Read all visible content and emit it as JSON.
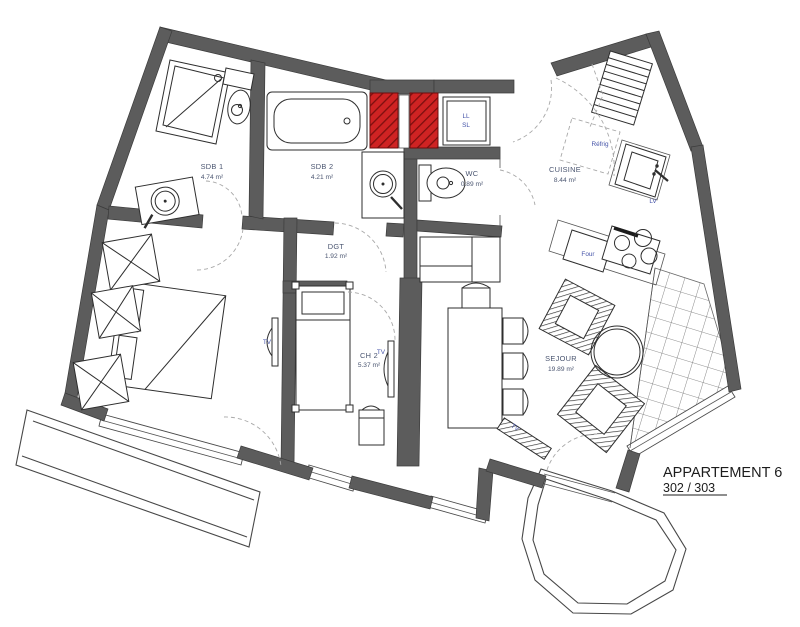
{
  "title": {
    "line1": "APPARTEMENT 6",
    "line2": "302 / 303"
  },
  "rooms": {
    "sdb1": {
      "name": "SDB 1",
      "area": "4.74 m²"
    },
    "sdb2": {
      "name": "SDB 2",
      "area": "4.21 m²"
    },
    "wc": {
      "name": "WC",
      "area": "0.89 m²"
    },
    "cuisine": {
      "name": "CUISINE",
      "area": "8.44 m²"
    },
    "dgt": {
      "name": "DGT",
      "area": "1.92 m²"
    },
    "ch2": {
      "name": "CH 2",
      "area": "5.37 m²"
    },
    "sejour": {
      "name": "SEJOUR",
      "area": "19.89 m²"
    }
  },
  "appliances": {
    "washer_line1": "LL",
    "washer_line2": "SL",
    "fridge": "Réfrig",
    "dishwasher": "LV",
    "oven": "Four",
    "tv_ch1": "TV",
    "tv_ch2": "TV",
    "tv_sejour": "TV"
  },
  "colors": {
    "wall": "#5c5c5c",
    "wall_outline": "#3c3c3c",
    "duct_red": "#cf2323",
    "duct_stripe": "#7c0f0f",
    "room_label": "#4a5570",
    "appliance_label": "#4453a8",
    "title_text": "#1c1c1c",
    "drawing_line": "#2e2e2e"
  }
}
